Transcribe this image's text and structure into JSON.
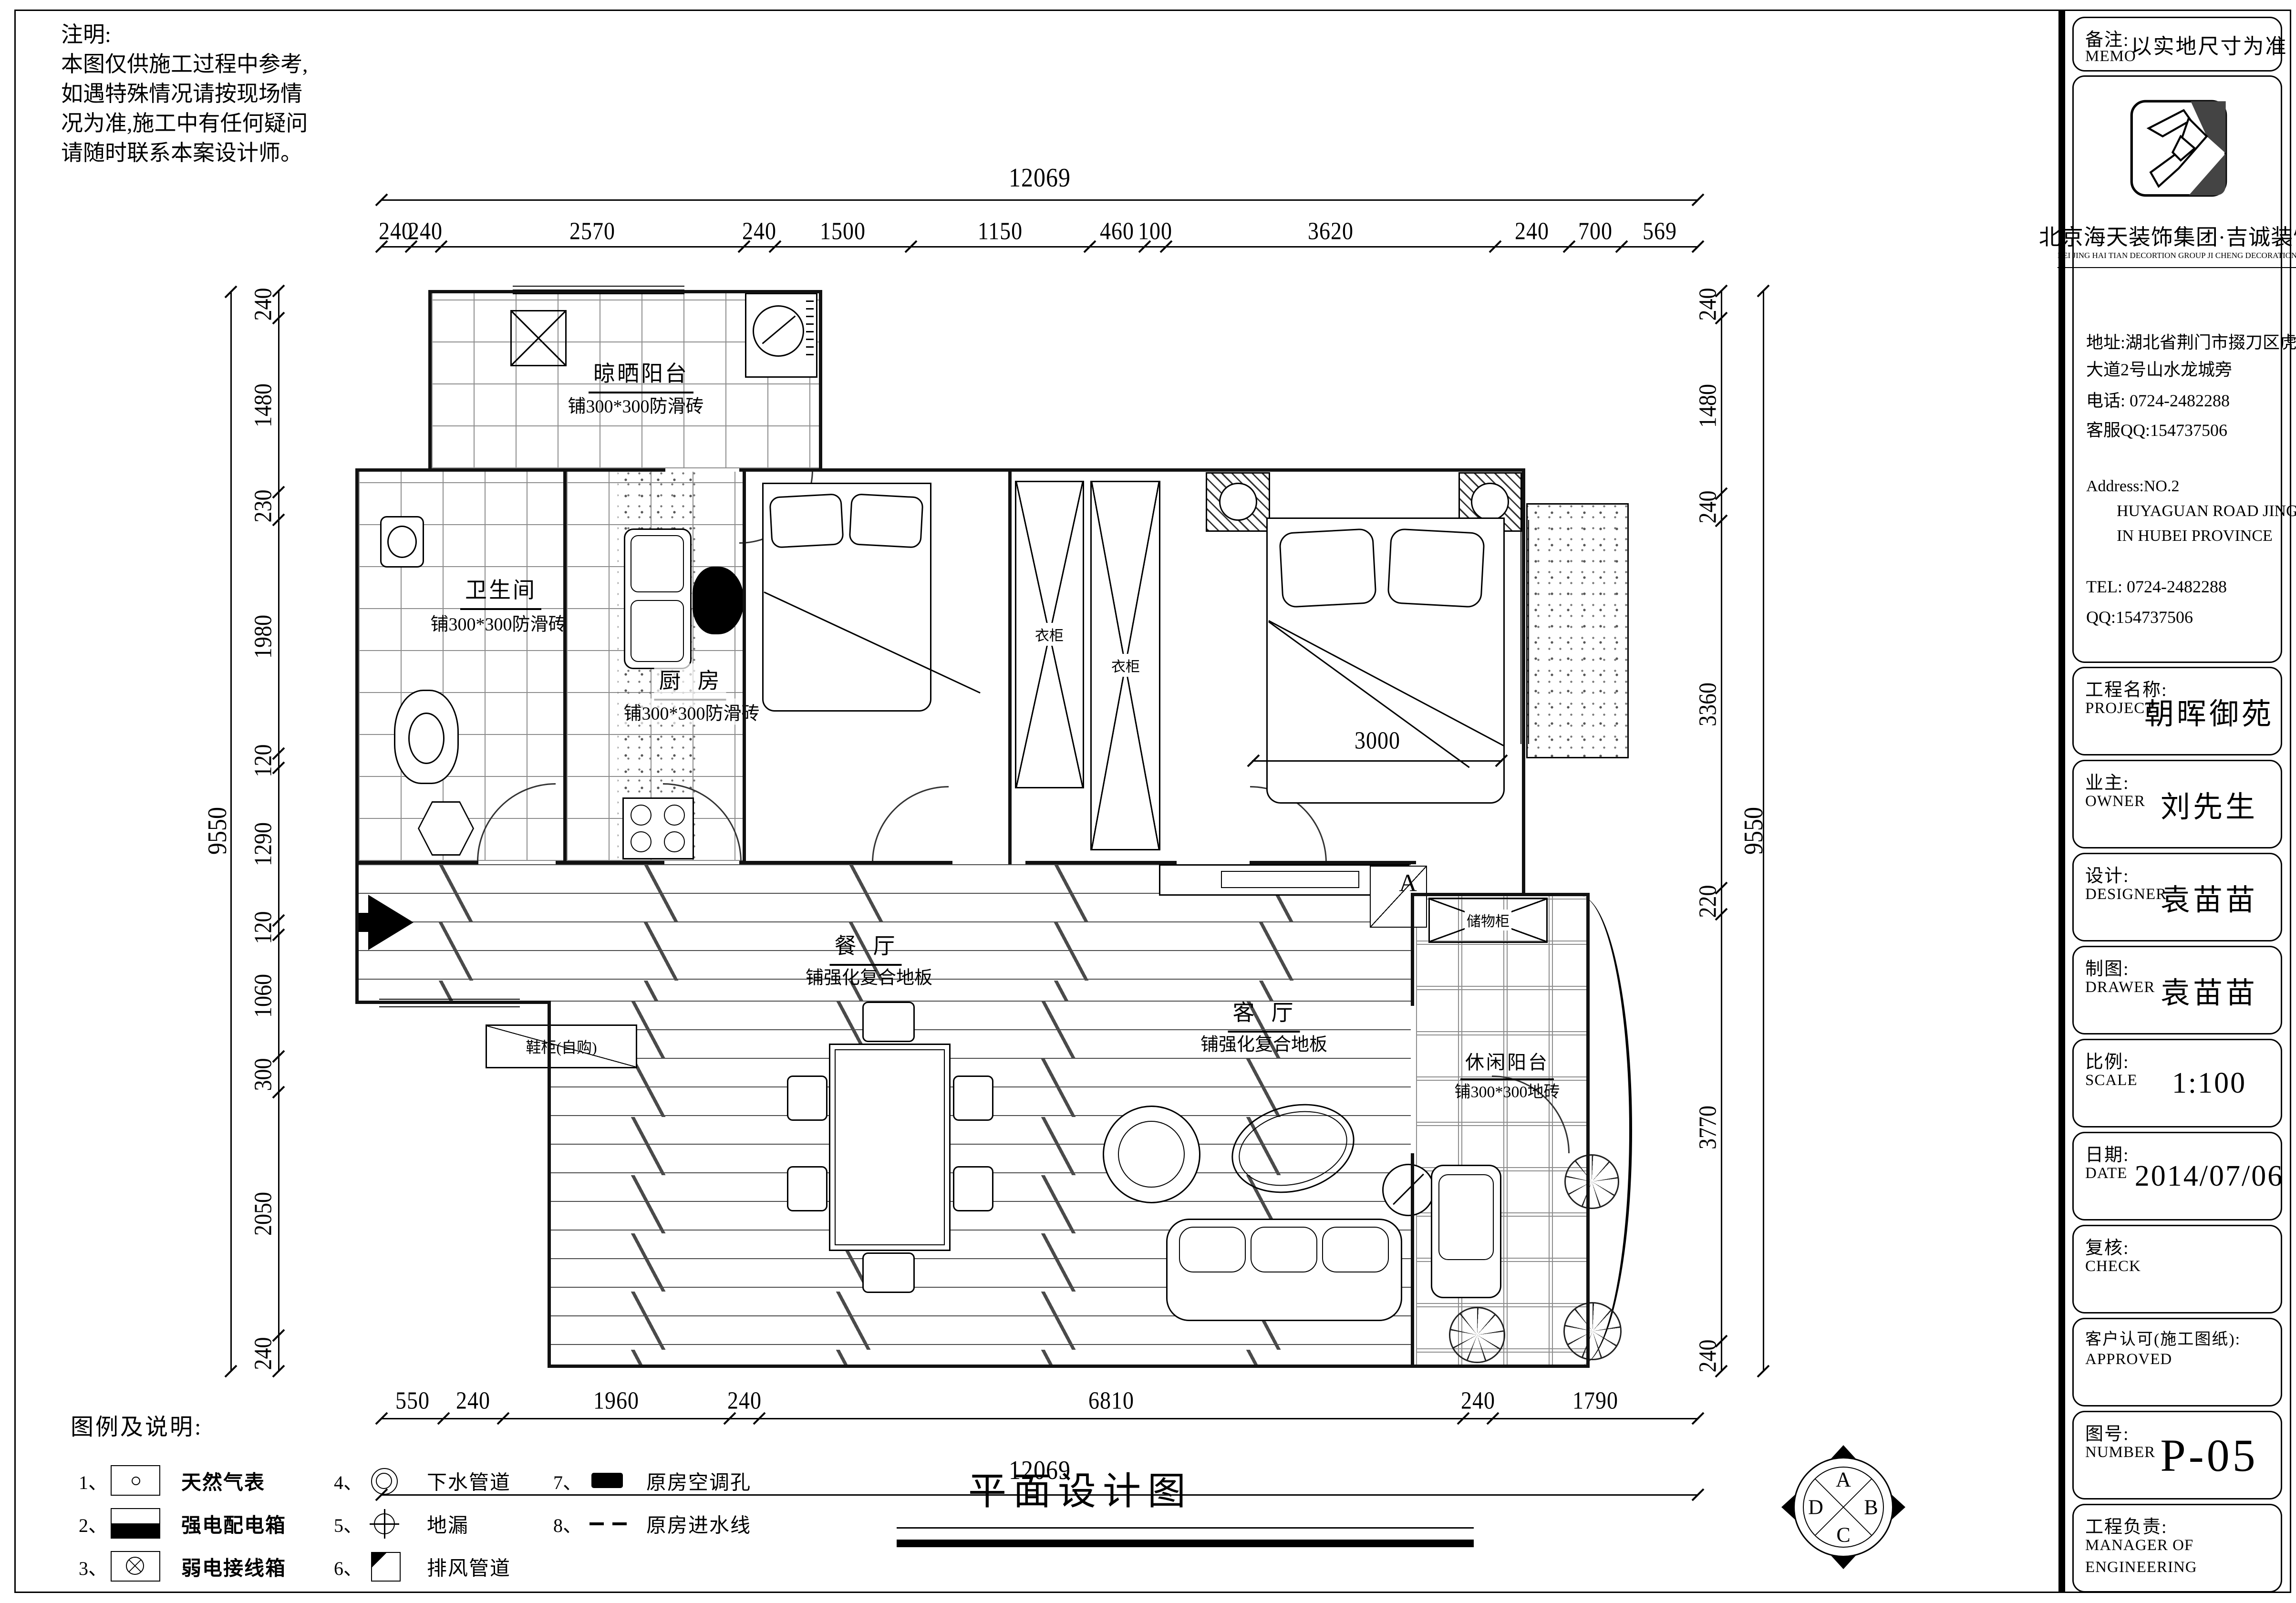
{
  "notes": {
    "title": "注明:",
    "lines": [
      "本图仅供施工过程中参考,",
      "如遇特殊情况请按现场情",
      "况为准,施工中有任何疑问",
      "请随时联系本案设计师。"
    ]
  },
  "memo": {
    "label": "备注:",
    "label_en": "MEMO",
    "value": "以实地尺寸为准"
  },
  "company": {
    "name": "北京海天装饰集团·吉诚装饰",
    "name_en": "BEI JING HAI TIAN DECORTION GROUP JI CHENG DECORATION",
    "address_line1": "地址:湖北省荆门市掇刀区虎牙关",
    "address_line2": "大道2号山水龙城旁",
    "phone": "电话: 0724-2482288",
    "service_qq": "客服QQ:154737506",
    "address_en1": "Address:NO.2",
    "address_en2": "HUYAGUAN ROAD JINGMEN",
    "address_en3": "IN HUBEI PROVINCE",
    "tel": "TEL: 0724-2482288",
    "qq": "QQ:154737506"
  },
  "title_rows": [
    {
      "label": "工程名称:",
      "en": "PROJECT",
      "value": "朝晖御苑"
    },
    {
      "label": "业主:",
      "en": "OWNER",
      "value": "刘先生"
    },
    {
      "label": "设计:",
      "en": "DESIGNER",
      "value": "袁苗苗"
    },
    {
      "label": "制图:",
      "en": "DRAWER",
      "value": "袁苗苗"
    },
    {
      "label": "比例:",
      "en": "SCALE",
      "value": "1:100"
    },
    {
      "label": "日期:",
      "en": "DATE",
      "value": "2014/07/06"
    },
    {
      "label": "复核:",
      "en": "CHECK",
      "value": ""
    },
    {
      "label": "客户认可(施工图纸):",
      "en": "APPROVED",
      "value": ""
    },
    {
      "label": "图号:",
      "en": "NUMBER",
      "value": "P-05"
    },
    {
      "label": "工程负责:",
      "en": "MANAGER OF",
      "en2": "ENGINEERING",
      "value": ""
    }
  ],
  "drawing_title": "平面设计图",
  "legend": {
    "title": "图例及说明:",
    "items": [
      {
        "no": "1、",
        "label": "天然气表"
      },
      {
        "no": "2、",
        "label": "强电配电箱"
      },
      {
        "no": "3、",
        "label": "弱电接线箱"
      },
      {
        "no": "4、",
        "label": "下水管道"
      },
      {
        "no": "5、",
        "label": "地漏"
      },
      {
        "no": "6、",
        "label": "排风管道"
      },
      {
        "no": "7、",
        "label": "原房空调孔"
      },
      {
        "no": "8、",
        "label": "原房进水线"
      }
    ]
  },
  "rooms": {
    "drying_balcony": {
      "name": "晾晒阳台",
      "sub": "铺300*300防滑砖"
    },
    "bathroom": {
      "name": "卫生间",
      "sub": "铺300*300防滑砖"
    },
    "kitchen": {
      "name": "厨  房",
      "sub": "铺300*300防滑砖"
    },
    "dining": {
      "name": "餐  厅",
      "sub": "铺强化复合地板"
    },
    "living": {
      "name": "客  厅",
      "sub": "铺强化复合地板"
    },
    "leisure_balcony": {
      "name": "休闲阳台",
      "sub": "铺300*300地砖"
    }
  },
  "labels": {
    "wardrobe1": "衣柜",
    "wardrobe2": "衣柜",
    "shoe_cabinet": "鞋柜(自购)",
    "storage": "储物柜",
    "section_a": "A",
    "bed_width": "3000"
  },
  "dims": {
    "top_total": "12069",
    "bottom_total": "12069",
    "left_total": "9550",
    "right_total": "9550",
    "top": [
      "240",
      "240",
      "2570",
      "240",
      "1500",
      "1150",
      "460",
      "100",
      "3620",
      "240",
      "700",
      "569"
    ],
    "bottom": [
      "550",
      "240",
      "1960",
      "240",
      "6810",
      "240",
      "1790"
    ],
    "left": [
      "240",
      "1480",
      "230",
      "1980",
      "120",
      "1290",
      "120",
      "1060",
      "300",
      "2050",
      "240"
    ],
    "right": [
      "240",
      "1480",
      "240",
      "3360",
      "220",
      "3770",
      "240"
    ]
  },
  "compass": {
    "n": "A",
    "e": "B",
    "s": "C",
    "w": "D"
  }
}
